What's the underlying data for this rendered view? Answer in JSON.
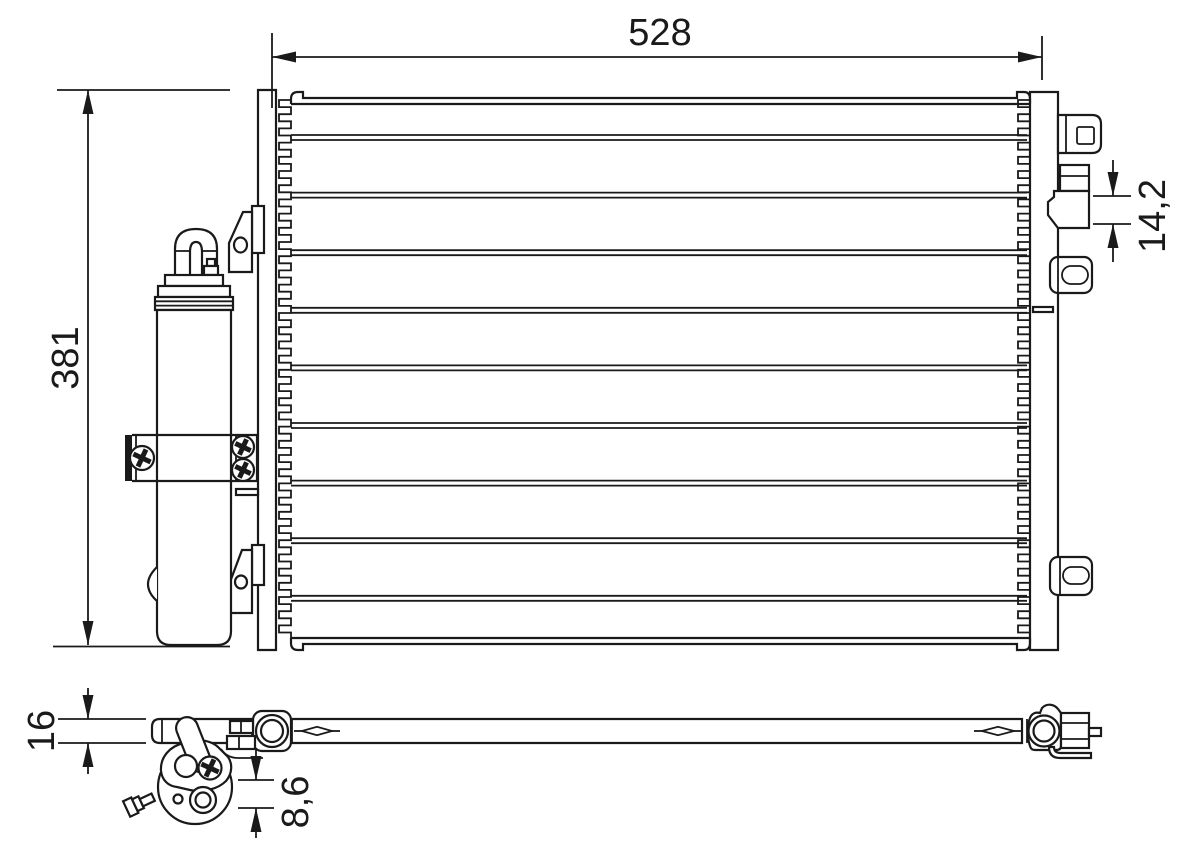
{
  "drawing": {
    "type": "technical-drawing",
    "subject": "condenser-with-receiver-drier",
    "background_color": "#ffffff",
    "line_color": "#1a1a1a",
    "dimensions": {
      "core_width": "528",
      "core_height": "381",
      "fitting_block_height": "14,2",
      "profile_depth": "16",
      "drier_port_offset": "8,6"
    }
  }
}
